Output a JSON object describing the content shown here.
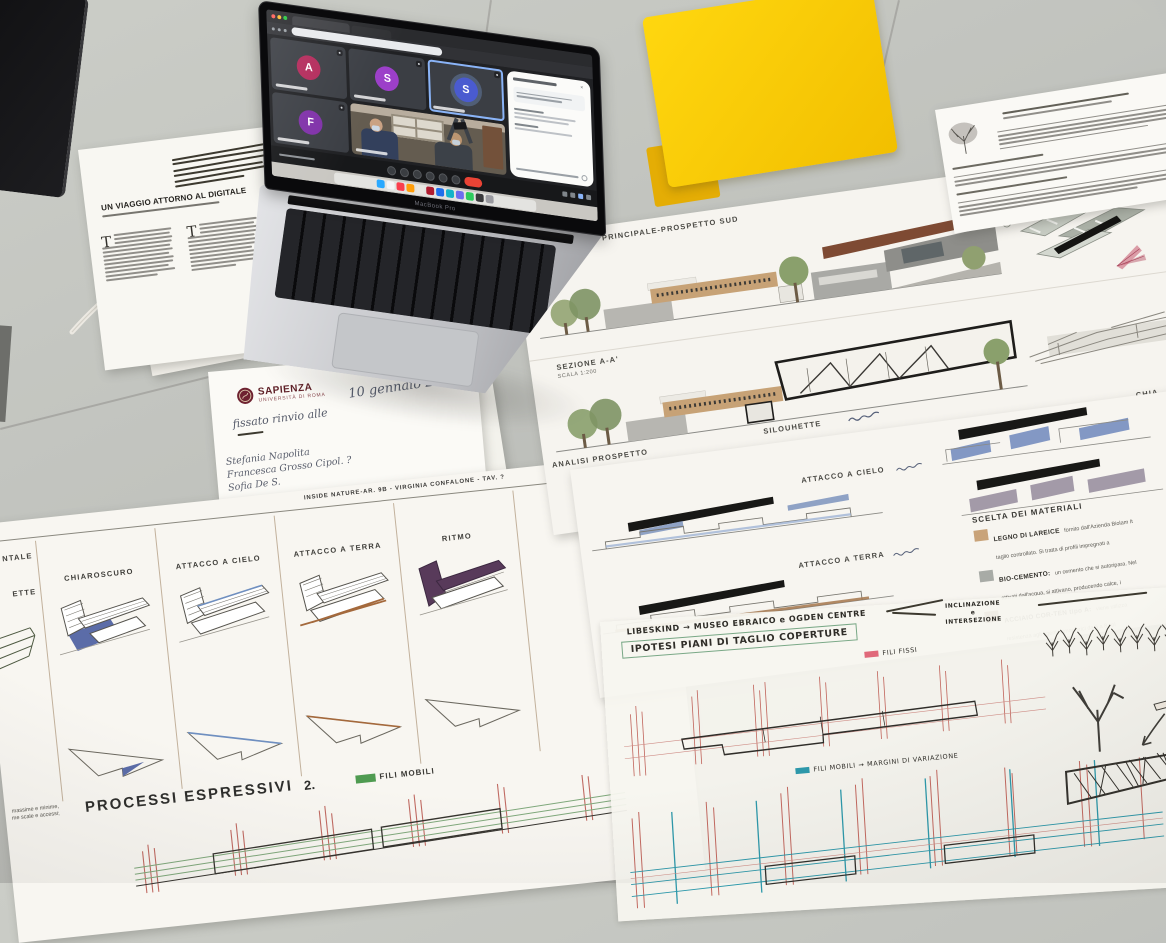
{
  "meet": {
    "tiles": [
      {
        "letter": "A",
        "style": "background:#b3295a"
      },
      {
        "letter": "S",
        "style": "background:#9c3fc9"
      },
      {
        "letter": "S",
        "style": "background:#4a5bd0"
      },
      {
        "letter": "F",
        "style": "background:#7f30a8"
      }
    ],
    "end_call_color": "#ea4335"
  },
  "laptop": {
    "brand": "MacBook Pro"
  },
  "sheet_prospetto": {
    "title_prospetto": "PROSPETTO PRINCIPALE-PROSPETTO SUD",
    "scale_prospetto": "SCALA 1:200",
    "title_sezione": "SEZIONE A-A'",
    "scale_sezione": "SCALA 1:200",
    "title_analisi": "ANALISI PROSPETTO",
    "label_silouhette": "SILOUHETTE",
    "label_chiaroscuro_partial": "CHIA"
  },
  "sheet_attacco": {
    "label_cielo": "ATTACCO A CIELO",
    "label_terra": "ATTACCO A TERRA",
    "materials_title": "SCELTA DEI MATERIALI",
    "materials": [
      {
        "name": "LEGNO DI LAREICE",
        "style": "background:#c9a379",
        "desc1": "fornito dall'Azienda Biolam It",
        "desc2": "taglio controllato. Si tratta di profili impregnati a"
      },
      {
        "name": "BIO-CEMENTO:",
        "style": "background:#a8aba6",
        "desc1": "un cemento che si autoripara. Nel",
        "desc2": "attivati dall'acqua, si attivano, producendo calce, i"
      },
      {
        "name": "ACCIAIO COR-TEN tipo A:",
        "style": "background:#7c5239",
        "desc1": "viene utilizza",
        "desc2": "resistenza agli agenti atmosferici da 5 a 8 vol"
      }
    ]
  },
  "sheet_tracing": {
    "hand_line1": "LIBESKIND → MUSEO EBRAICO e OGDEN CENTRE",
    "hand_line2": "IPOTESI PIANI DI TAGLIO COPERTURE",
    "legend_fissi": "FILI FISSI",
    "fissi_style": "background:#e0697a",
    "legend_mobili": "FILI MOBILI → MARGINI DI VARIAZIONE",
    "mobili_style": "background:#2d98aa",
    "note1": "INCLINAZIONE",
    "note2": "e",
    "note3": "INTERSEZIONE"
  },
  "sheet_processi": {
    "header": "INSIDE NATURE-AR. 9B - VIRGINIA CONFALONE - TAV. ?",
    "col0a": "NTALE",
    "col0b": "ETTE",
    "columns": [
      "CHIAROSCURO",
      "ATTACCO A CIELO",
      "ATTACCO A TERRA",
      "RITMO"
    ],
    "footer_title": "PROCESSI ESPRESSIVI",
    "footer_number": "2.",
    "legend": "FILI MOBILI",
    "legend_style": "background:#4f9b51",
    "note1": "massime e minime,",
    "note2": "me scale e accessi;"
  },
  "paper_sapienza": {
    "logo": "SAPIENZA",
    "logo_sub": "UNIVERSITÀ DI ROMA",
    "date": "10 gennaio 2022",
    "line1": "fissato rinvio alle",
    "name1": "Stefania Napolita",
    "name2": "Francesca Grosso Cipol. ?",
    "name3": "Sofia De S."
  },
  "paper_digitale": {
    "title": "UN VIAGGIO ATTORNO AL DIGITALE",
    "dropcap1": "T",
    "dropcap2": "T"
  }
}
